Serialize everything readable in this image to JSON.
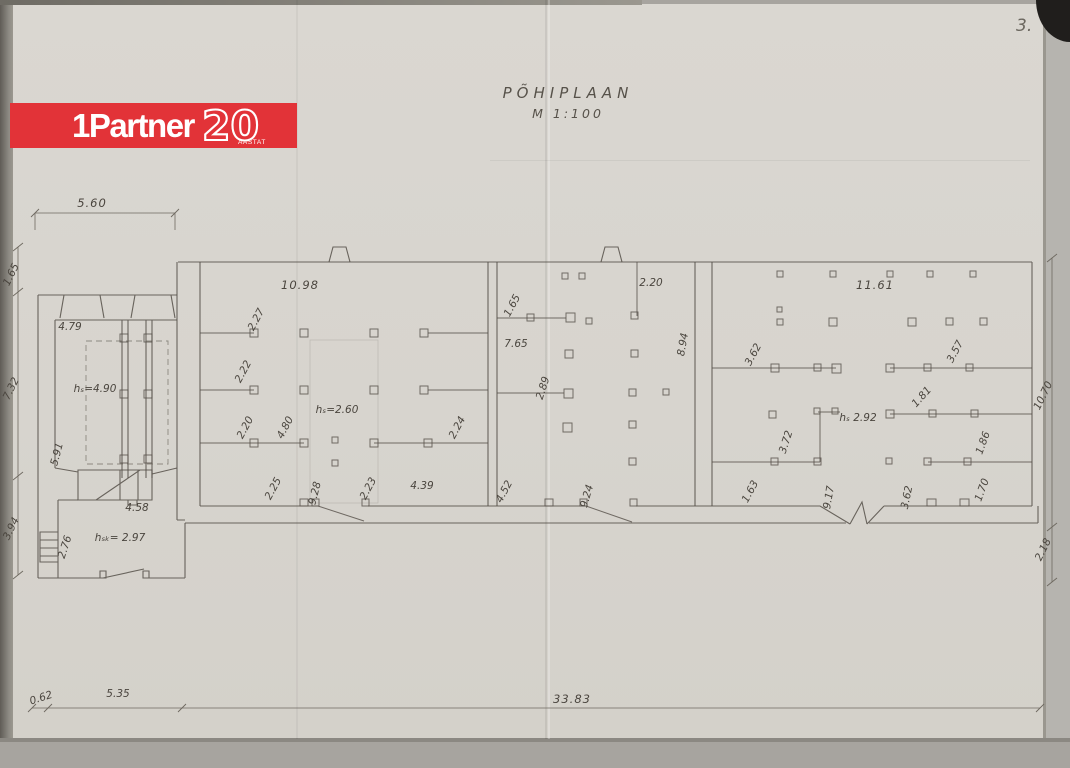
{
  "scan": {
    "page_number": "3."
  },
  "logo": {
    "brand": "1Partner",
    "anniversary": "20",
    "caption": "AASTAT",
    "bg_color": "#e23338"
  },
  "titleblock": {
    "heading": "PÕHIPLAAN",
    "scale": "M 1:100"
  },
  "dims": {
    "top_width": "5.60",
    "left": {
      "a": "1.65",
      "b": "7.32",
      "c": "3.94"
    },
    "right": {
      "a": "10.70",
      "b": "2.18"
    },
    "bottom": {
      "a": "0.62",
      "b": "5.35",
      "c": "33.83"
    }
  },
  "wing": {
    "width": "4.79",
    "height": "hₛ=4.90",
    "depth": "5.91"
  },
  "annex": {
    "stair_width": "4.58",
    "height": "hₛₖ= 2.97",
    "window": "2.76"
  },
  "hall1": {
    "width": "10.98",
    "a": "2.27",
    "b": "2.22",
    "c": "2.20",
    "d": "4.80",
    "height": "hₛ=2.60",
    "e": "2.24",
    "f": "2.25",
    "g": "9.28",
    "h2": "2.23",
    "i": "4.39"
  },
  "hall2": {
    "a": "2.20",
    "b": "1.65",
    "c": "7.65",
    "d": "2.89",
    "depth": "8.94",
    "e": "4.52",
    "f": "9.24"
  },
  "hall3": {
    "width": "11.61",
    "a": "3.62",
    "b": "3.57",
    "c": "1.81",
    "height": "hₛ 2.92",
    "d": "3.72",
    "e": "1.86",
    "f": "1.63",
    "g": "9.17",
    "h2": "3.62",
    "i": "1.70"
  }
}
